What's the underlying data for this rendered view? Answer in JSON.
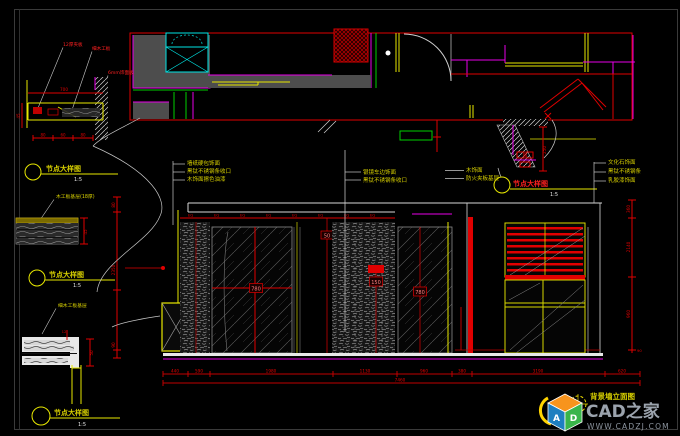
{
  "watermark": {
    "brand": "CAD之家",
    "url": "WWW.CADZJ.COM",
    "cube_letter_a": "A",
    "cube_letter_d": "D"
  },
  "titles": {
    "d1": {
      "label": "节点大样图",
      "scale": "1:5"
    },
    "d2": {
      "label": "节点大样图",
      "scale": "1:5"
    },
    "d3": {
      "label": "节点大样图",
      "scale": "1:5"
    },
    "d4": {
      "label": "节点大样图",
      "scale": "1:5"
    },
    "elevation": {
      "label": "背景墙立面图"
    }
  },
  "callouts": {
    "left": [
      "墙纸硬包饰面",
      "黑钛不锈钢条收口",
      "木饰面擦色油漆"
    ],
    "center": [
      "银镜车边饰面",
      "黑钛不锈钢条收口"
    ],
    "window": [
      "木饰面",
      "防火夹板基层"
    ],
    "right": [
      "文化石饰面",
      "黑钛不锈钢条",
      "乳胶漆饰面"
    ],
    "d1_labels": [
      "12厚夹板",
      "细木工板",
      "6mm饰面板"
    ],
    "d2_label": "木工板基层(18厚)",
    "d3_label": "细木工板基层"
  },
  "dims": {
    "bottom": [
      "440",
      "590",
      "1980",
      "1130",
      "960",
      "380",
      "3190",
      "620"
    ],
    "bottom_total": "7460",
    "right": [
      "360",
      "2140",
      "960",
      "90"
    ],
    "left": [
      "80",
      "2350",
      "90"
    ],
    "d1_top": "700",
    "d1_left": "45",
    "d1_bottom": [
      "80",
      "60",
      "80"
    ],
    "d2_right": "45",
    "d3_right": "50",
    "d3_top": "12",
    "d4_right": "250",
    "box1": "780",
    "box2": "50",
    "box3": "150",
    "box4": "780",
    "eq": "EQ"
  },
  "colors": {
    "line_red": "#e00000",
    "line_yellow": "#e8e800",
    "line_cyan": "#00e5e5",
    "line_magenta": "#e800e8",
    "line_green": "#00d000",
    "line_white": "#d8d8d8",
    "wall_gray": "#4d4d4d",
    "watermark_gray": "#9ba3ad"
  }
}
